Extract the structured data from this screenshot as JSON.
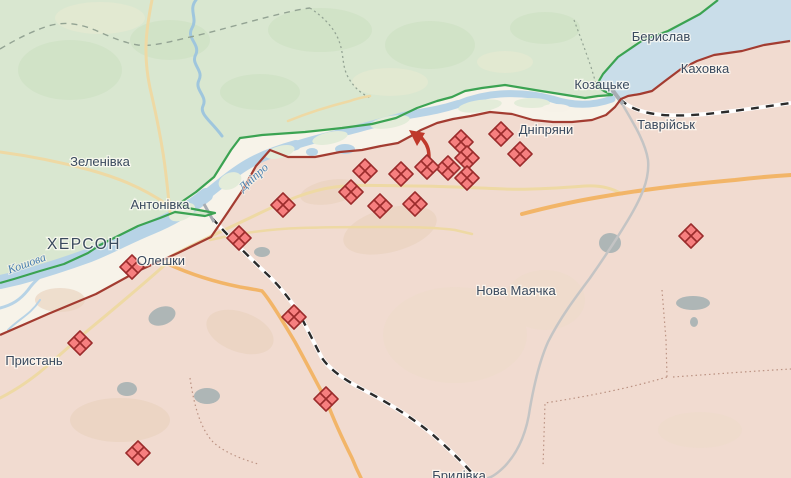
{
  "map": {
    "title": "Frontline map — Kherson / Dnipro river area",
    "labels": {
      "towns": [
        {
          "id": "zelenivka",
          "text": "Зеленівка",
          "x": 100,
          "y": 166,
          "type": "town"
        },
        {
          "id": "antonivka",
          "text": "Антонівка",
          "x": 160,
          "y": 209,
          "type": "town"
        },
        {
          "id": "kherson",
          "text": "ХЕРСОН",
          "x": 84,
          "y": 249,
          "type": "city"
        },
        {
          "id": "oleshky",
          "text": "Олешки",
          "x": 161,
          "y": 265,
          "type": "town"
        },
        {
          "id": "prystan",
          "text": "Пристань",
          "x": 34,
          "y": 365,
          "type": "town"
        },
        {
          "id": "dnipriany",
          "text": "Дніпряни",
          "x": 546,
          "y": 134,
          "type": "town"
        },
        {
          "id": "kozatske",
          "text": "Козацьке",
          "x": 602,
          "y": 89,
          "type": "town"
        },
        {
          "id": "beryslav",
          "text": "Берислав",
          "x": 661,
          "y": 41,
          "type": "town"
        },
        {
          "id": "kakhovka",
          "text": "Каховка",
          "x": 705,
          "y": 73,
          "type": "town"
        },
        {
          "id": "tavriisk",
          "text": "Таврійськ",
          "x": 666,
          "y": 129,
          "type": "town"
        },
        {
          "id": "nova-maiachka",
          "text": "Нова Маячка",
          "x": 516,
          "y": 295,
          "type": "town"
        },
        {
          "id": "brylivka",
          "text": "Брилівка",
          "x": 459,
          "y": 480,
          "type": "town"
        }
      ],
      "water": [
        {
          "id": "dnipro-river",
          "text": "Дніпро",
          "x": 256,
          "y": 180,
          "rotate": -42,
          "size": 12
        },
        {
          "id": "koshova-river",
          "text": "Кошова",
          "x": 28,
          "y": 267,
          "rotate": -20,
          "size": 10.5
        }
      ]
    },
    "markers": {
      "clash_marker_meaning": "fighting / combat clashes (diamond)",
      "clashes": [
        [
          461,
          142
        ],
        [
          501,
          134
        ],
        [
          520,
          154
        ],
        [
          467,
          158
        ],
        [
          467,
          178
        ],
        [
          448,
          168
        ],
        [
          427,
          167
        ],
        [
          401,
          174
        ],
        [
          365,
          171
        ],
        [
          351,
          192
        ],
        [
          380,
          206
        ],
        [
          415,
          204
        ],
        [
          283,
          205
        ],
        [
          239,
          238
        ],
        [
          132,
          267
        ],
        [
          80,
          343
        ],
        [
          294,
          317
        ],
        [
          326,
          399
        ],
        [
          138,
          453
        ],
        [
          691,
          236
        ]
      ],
      "attack_arrow": {
        "x": 422,
        "y": 143,
        "direction": "northwest"
      }
    },
    "colors": {
      "friendly_zone": "#d9e7d0",
      "occupied_zone": "#f1dbd0",
      "floodplain": "#f7f3e9",
      "reservoir": "#c9dde9",
      "river": "#b7d3e6",
      "island": "#e3ecd9",
      "front_line_friendly": "#3ba352",
      "front_line_occupied": "#a33c31",
      "clash_fill": "#f67f7f",
      "clash_stroke": "#9b2c2c",
      "arrow": "#c0392b",
      "road_major": "#f2b568",
      "road_minor": "#eed9a4",
      "road_gray": "#c4c4c4",
      "railway": "#2b2b2b",
      "boundary": "#93a393",
      "boundary_pink": "#bb9282",
      "forest": "#aeb6b6",
      "label_town": "#3a4a5e",
      "label_water": "#4a80b0"
    }
  }
}
